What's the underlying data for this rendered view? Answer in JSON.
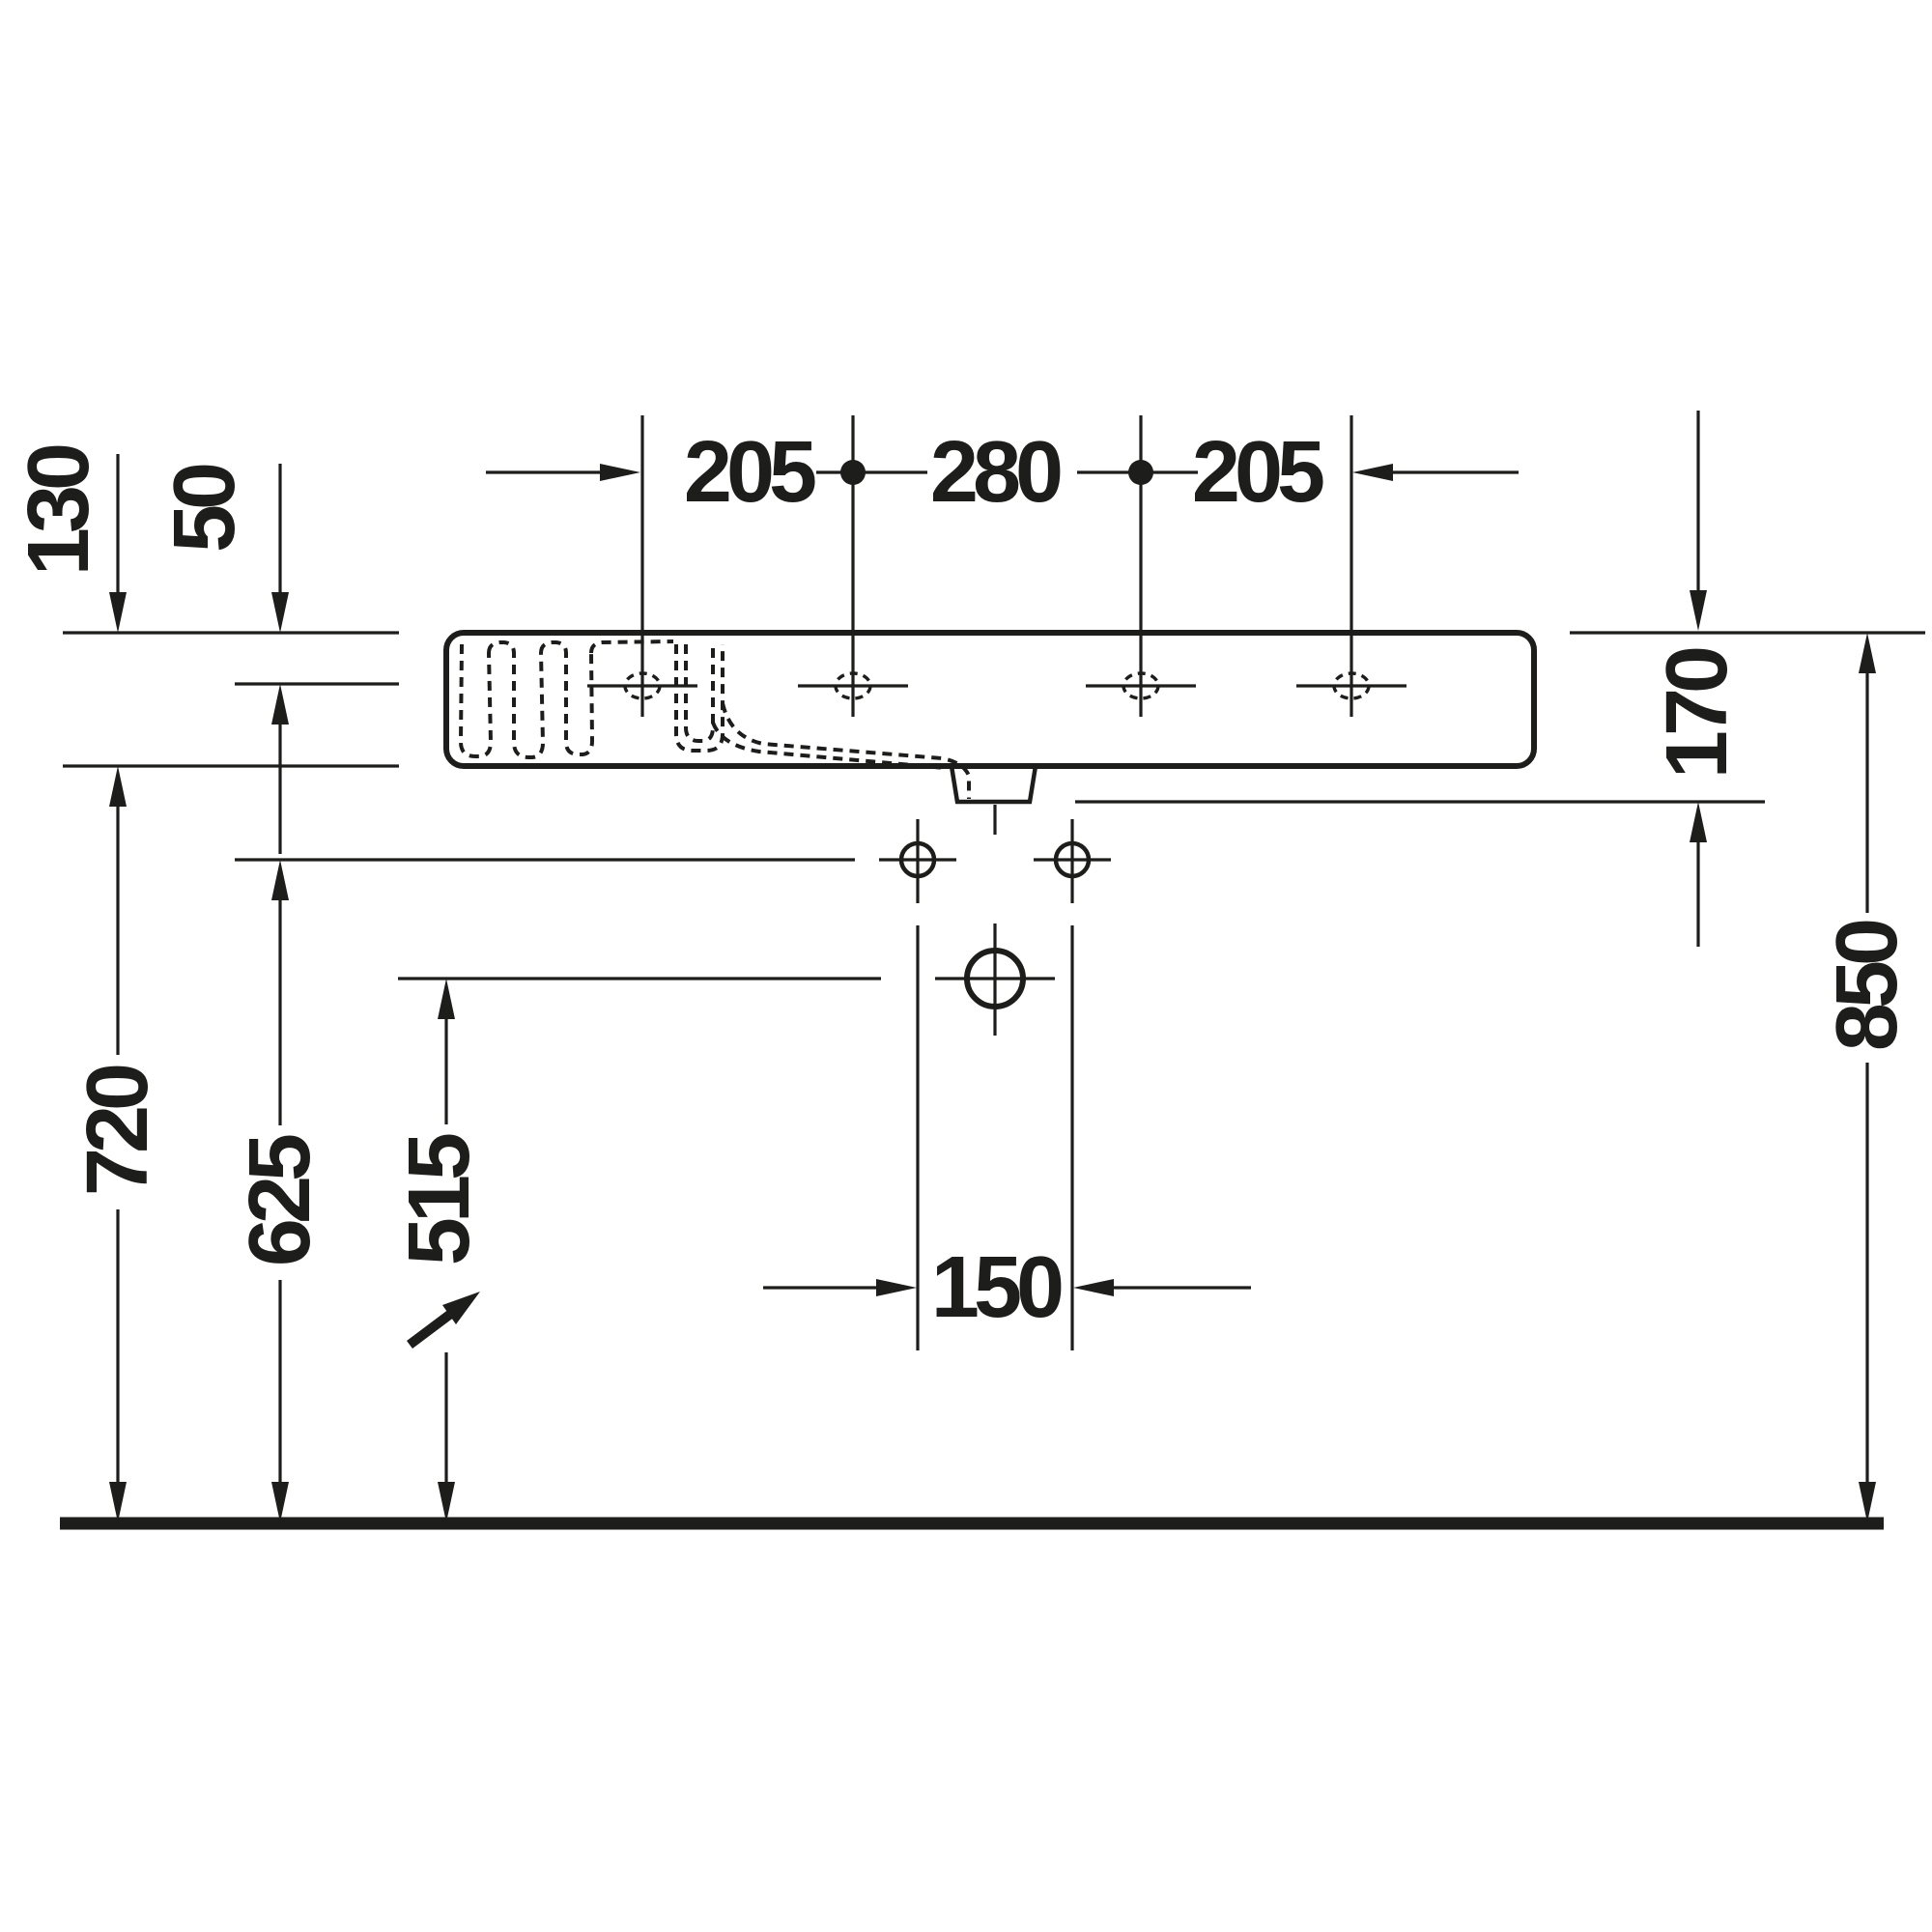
{
  "drawing": {
    "type": "technical-dimension-drawing",
    "subject": "wall-mounted washbasin, side section view",
    "unit": "mm",
    "colors": {
      "line": "#1d1d1b",
      "background": "#ffffff"
    },
    "dims": {
      "hole_spacing_left": "205",
      "hole_spacing_mid": "280",
      "hole_spacing_right": "205",
      "body_height": "130",
      "rim_to_ledge": "50",
      "rim_to_mounting": "170",
      "floor_to_rim": "850",
      "floor_to_underside": "720",
      "floor_to_fixing_holes": "625",
      "floor_to_drain": "515",
      "fixing_hole_spacing": "150"
    }
  }
}
